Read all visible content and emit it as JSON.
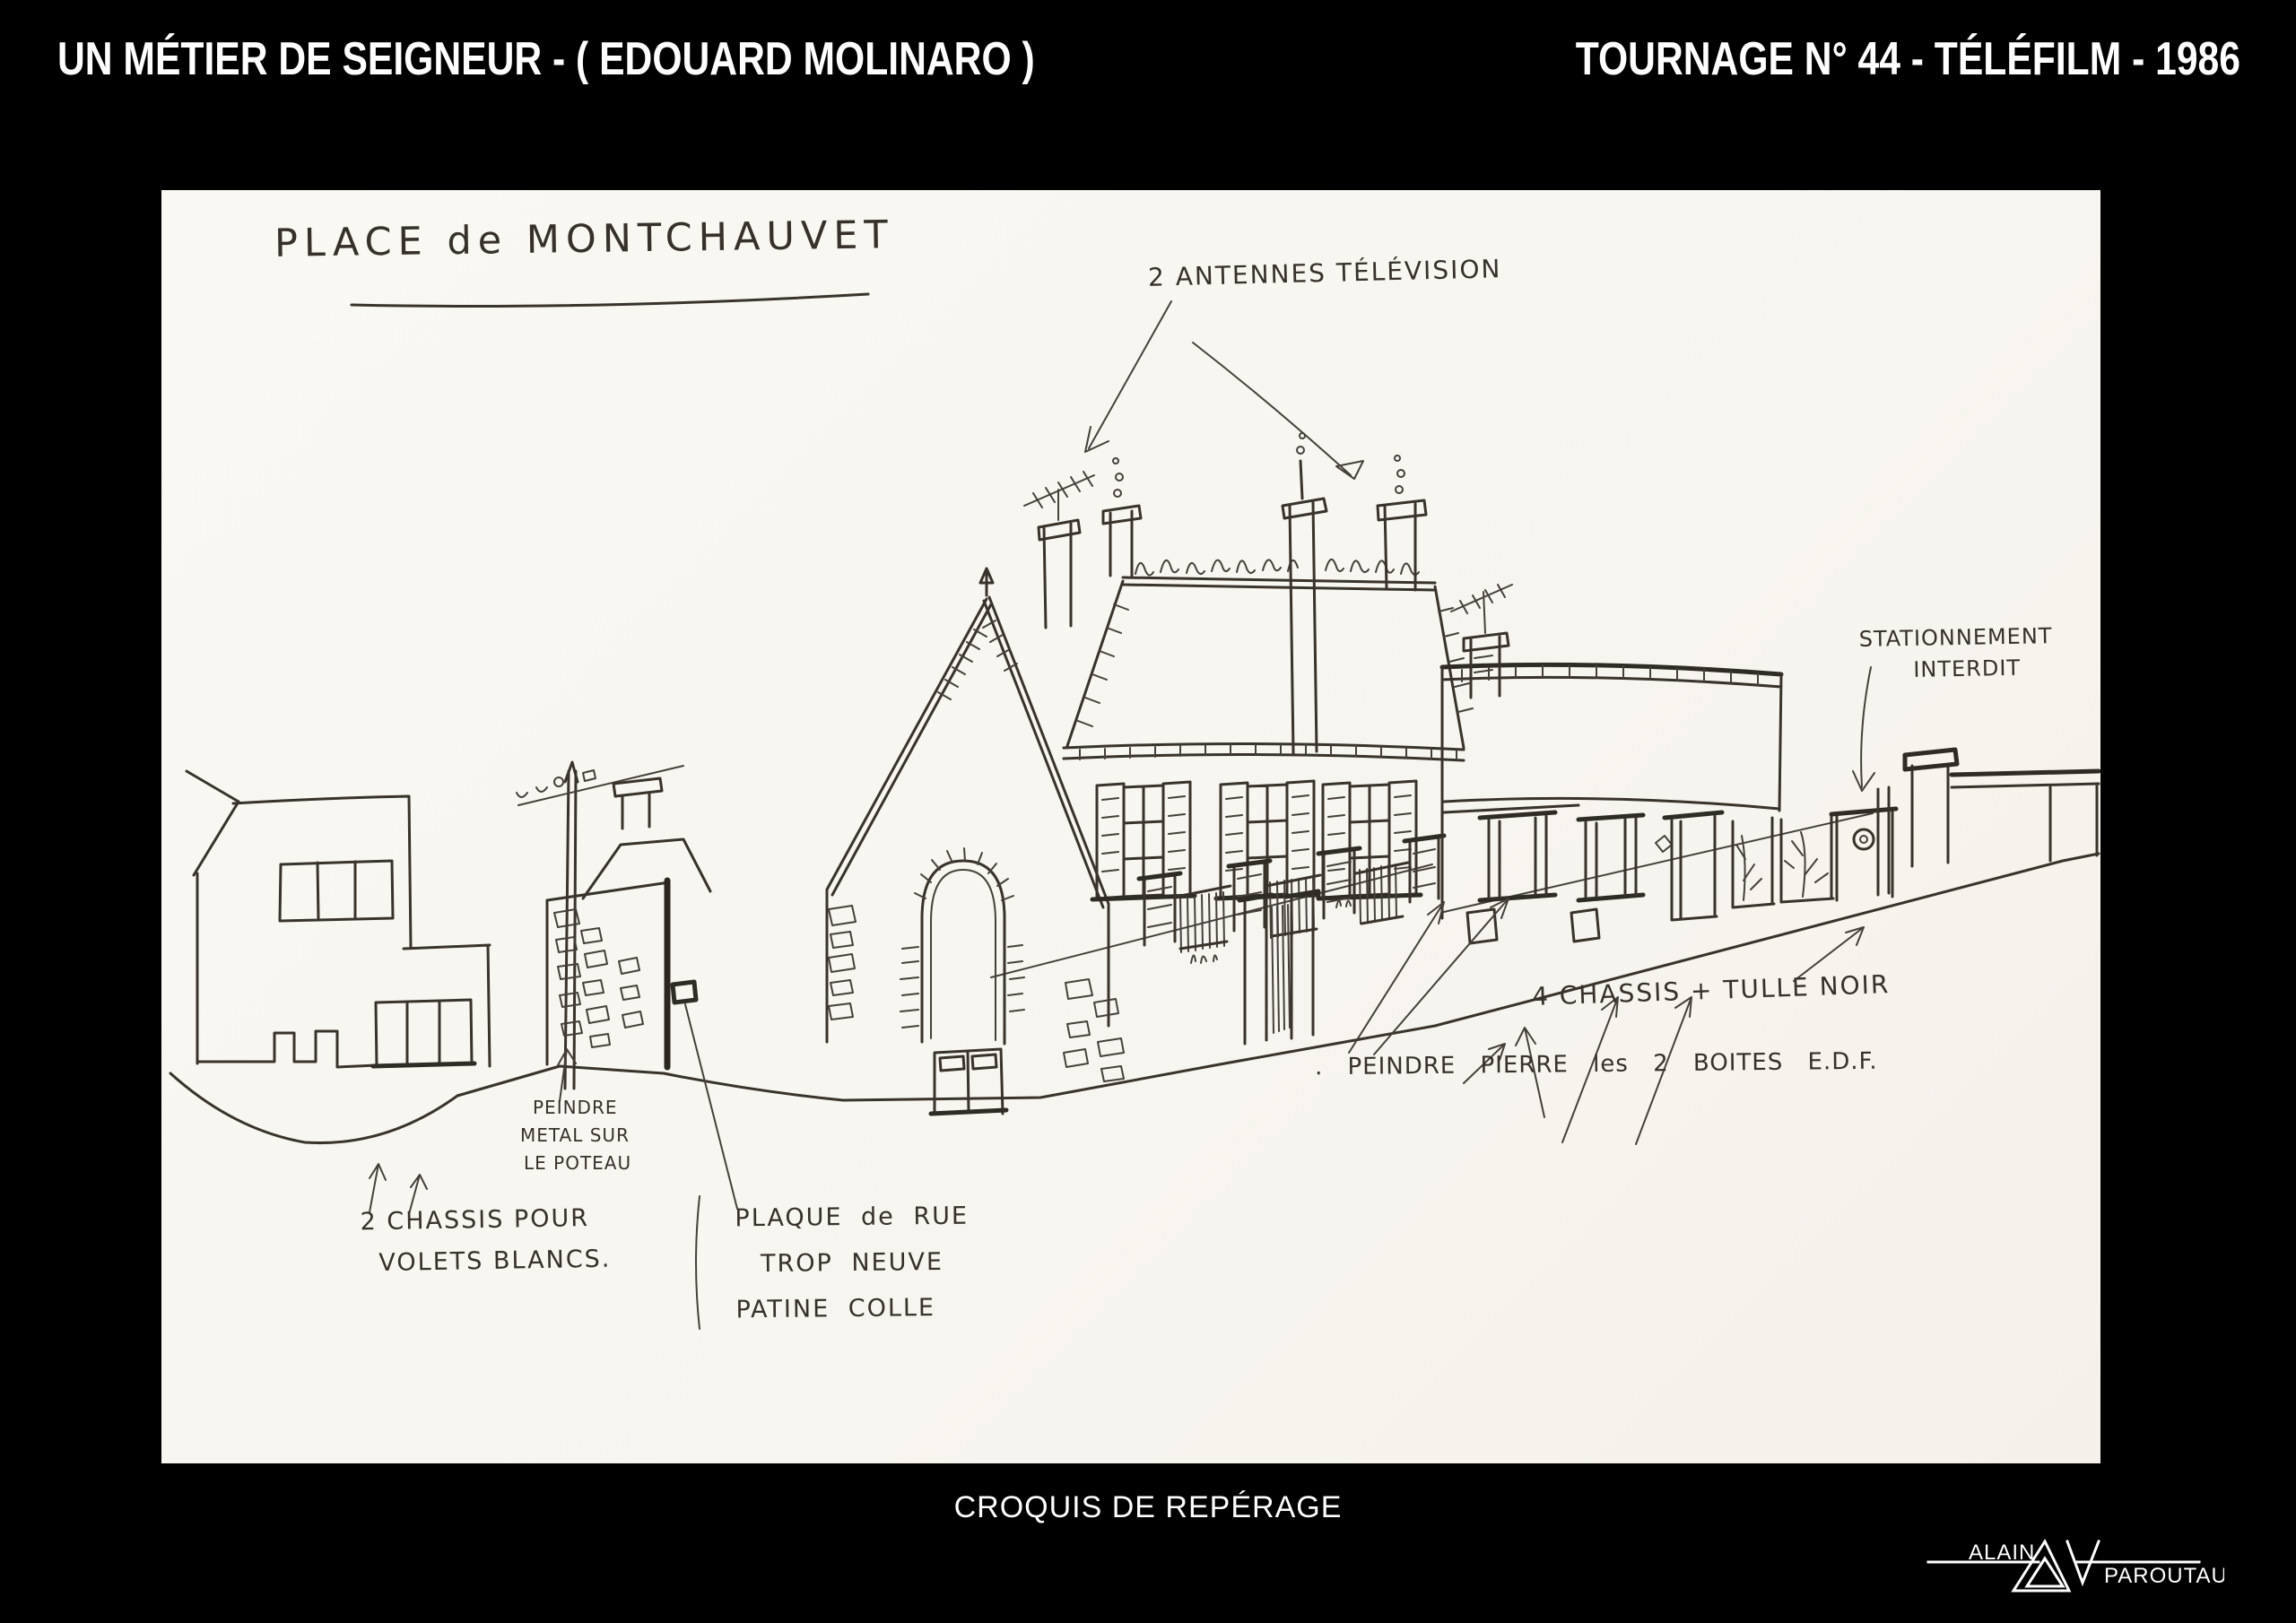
{
  "header": {
    "left_title": "UN MÉTIER DE SEIGNEUR - ( EDOUARD MOLINARO )",
    "right_title": "TOURNAGE N° 44 - TÉLÉFILM - 1986"
  },
  "sketch": {
    "title": "PLACE de MONTCHAUVET",
    "annotations": {
      "antennas": "2 ANTENNES TÉLÉVISION",
      "no_parking": [
        "STATIONNEMENT",
        "INTERDIT"
      ],
      "chassis_tulle": "4 CHASSIS + TULLE NOIR",
      "peindre_pierre": ". PEINDRE PIERRE les 2 BOITES E.D.F.",
      "peindre_metal": [
        "PEINDRE",
        "METAL SUR",
        "LE POTEAU"
      ],
      "chassis_volets": [
        "2 CHASSIS POUR",
        "VOLETS BLANCS."
      ],
      "plaque": [
        "PLAQUE de RUE",
        "TROP NEUVE",
        "PATINE COLLE"
      ]
    }
  },
  "footer": {
    "caption": "CROQUIS DE REPÉRAGE"
  },
  "logo": {
    "first_name": "ALAIN",
    "last_name": "PAROUTAUD"
  },
  "colors": {
    "background": "#000000",
    "paper": "#f8f6f1",
    "ink": "#36312a",
    "header_text": "#ffffff"
  }
}
